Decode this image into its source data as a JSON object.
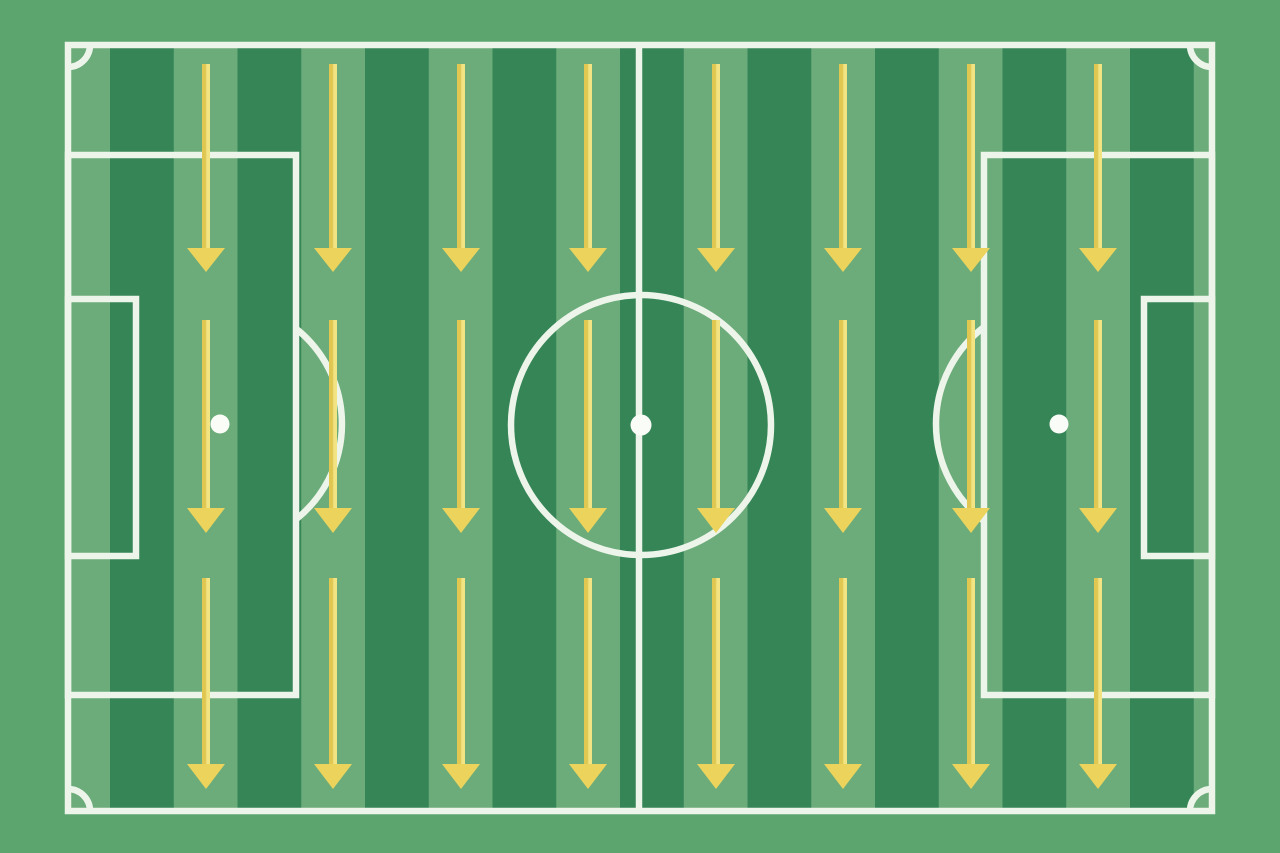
{
  "diagram": {
    "type": "soccer-pitch-tactics-board",
    "description": "Top-down striped football pitch with three rows of downward yellow tactic arrows",
    "canvas": {
      "width": 1280,
      "height": 853
    }
  },
  "colors": {
    "background": "#5ca56f",
    "stripe_dark": "#358557",
    "stripe_light": "#6cab7a",
    "line": "#edf5ea",
    "spot": "#fafdf7",
    "arrow_shaft_dark": "#dfc751",
    "arrow_shaft_light": "#f2e383",
    "arrow_head": "#ecd45c"
  },
  "pitch": {
    "outer": {
      "x": 68,
      "y": 45,
      "w": 1144,
      "h": 766
    },
    "line_width": 6.5,
    "stripes": {
      "first_light_x": 46.25,
      "stripe_width": 63.75,
      "period": 127.5,
      "light_count": 10
    },
    "halfway_line_x": 639,
    "center_circle": {
      "cx": 641,
      "cy": 425,
      "r": 130
    },
    "center_spot": {
      "cx": 641,
      "cy": 425,
      "r": 10.5
    },
    "penalty_area_left": {
      "x": 68,
      "y": 155,
      "w": 228,
      "h": 540
    },
    "penalty_area_right": {
      "x": 984,
      "y": 155,
      "w": 228,
      "h": 540
    },
    "goal_area_left": {
      "x": 68,
      "y": 299,
      "w": 68,
      "h": 257
    },
    "goal_area_right": {
      "x": 1144,
      "y": 299,
      "w": 68,
      "h": 257
    },
    "penalty_spot_left": {
      "cx": 220,
      "cy": 424,
      "r": 9.5
    },
    "penalty_spot_right": {
      "cx": 1059,
      "cy": 424,
      "r": 9.5
    },
    "penalty_arc_left": "M 296 328.6 A 122 122 0 0 1 296 519.4",
    "penalty_arc_right": "M 984 327 A 122 122 0 0 0 984 521",
    "corner_arcs": [
      "M 68 67 A 22 22 0 0 0 90 45",
      "M 1190 45 A 22 22 0 0 0 1212 67",
      "M 1212 789 A 22 22 0 0 0 1190 811",
      "M 90 811 A 22 22 0 0 0 68 789"
    ]
  },
  "arrows": {
    "glyph": "arrow-down",
    "direction": "down",
    "columns_x": [
      206,
      333,
      461,
      588,
      716,
      843,
      971,
      1098
    ],
    "rows": [
      {
        "shaft_top": 64,
        "head_top": 248,
        "tip": 272
      },
      {
        "shaft_top": 320,
        "head_top": 508,
        "tip": 533
      },
      {
        "shaft_top": 578,
        "head_top": 764,
        "tip": 789
      }
    ],
    "shaft_width": 8,
    "head_width": 38
  }
}
